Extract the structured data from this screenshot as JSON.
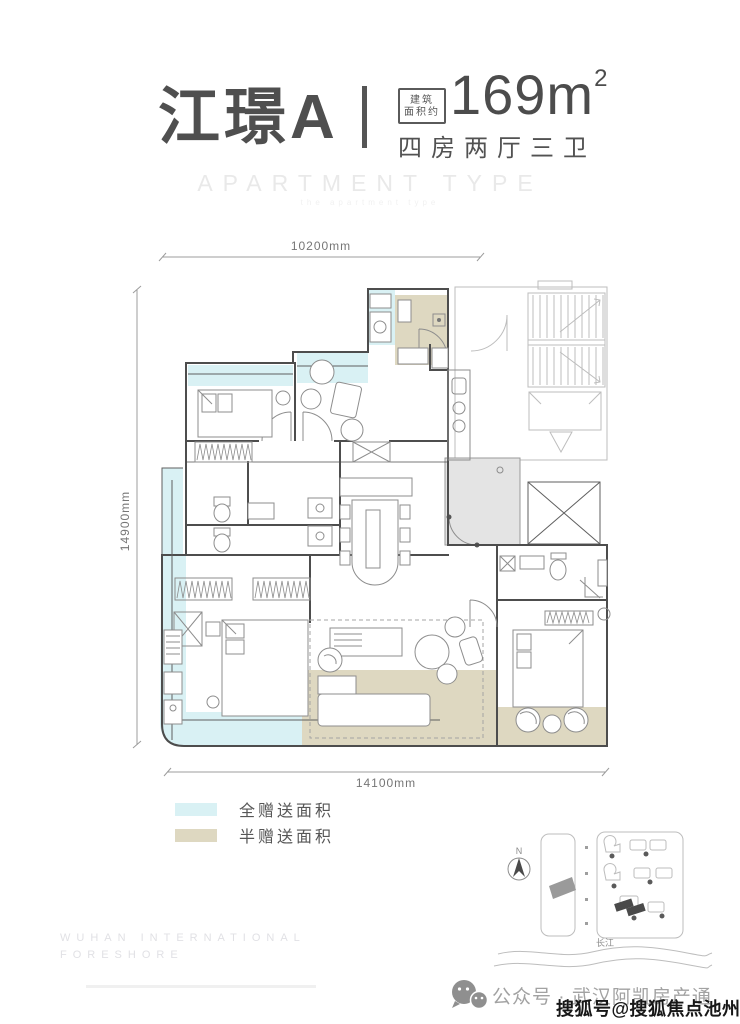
{
  "header": {
    "title": "江璟A",
    "area_label_top": "建筑",
    "area_label_bottom": "面积约",
    "area_value": "169m",
    "area_exponent": "2",
    "rooms_summary": "四房两厅三卫",
    "type_caption": "APARTMENT TYPE",
    "type_caption_sub": "the apartment type"
  },
  "plan": {
    "dim_top": "10200mm",
    "dim_left": "14900mm",
    "dim_bottom": "14100mm"
  },
  "legend": {
    "items": [
      {
        "label": "全赠送面积",
        "color": "#d9f1f4"
      },
      {
        "label": "半赠送面积",
        "color": "#ded8c1"
      }
    ]
  },
  "site_map": {
    "north": "N",
    "river": "长江"
  },
  "footer": {
    "brand_line1": "WUHAN INTERNATIONAL",
    "brand_line2": "FORESHORE",
    "wechat_label": "公众号 · 武汉阿凯房产通",
    "watermark": "搜狐号@搜狐焦点池州站"
  },
  "colors": {
    "gift_full": "#d9f1f4",
    "gift_half": "#ded8c1",
    "wall": "#4d4d4d",
    "shaft_gray": "#e4e4e4",
    "title_text": "#4f4f4f"
  }
}
